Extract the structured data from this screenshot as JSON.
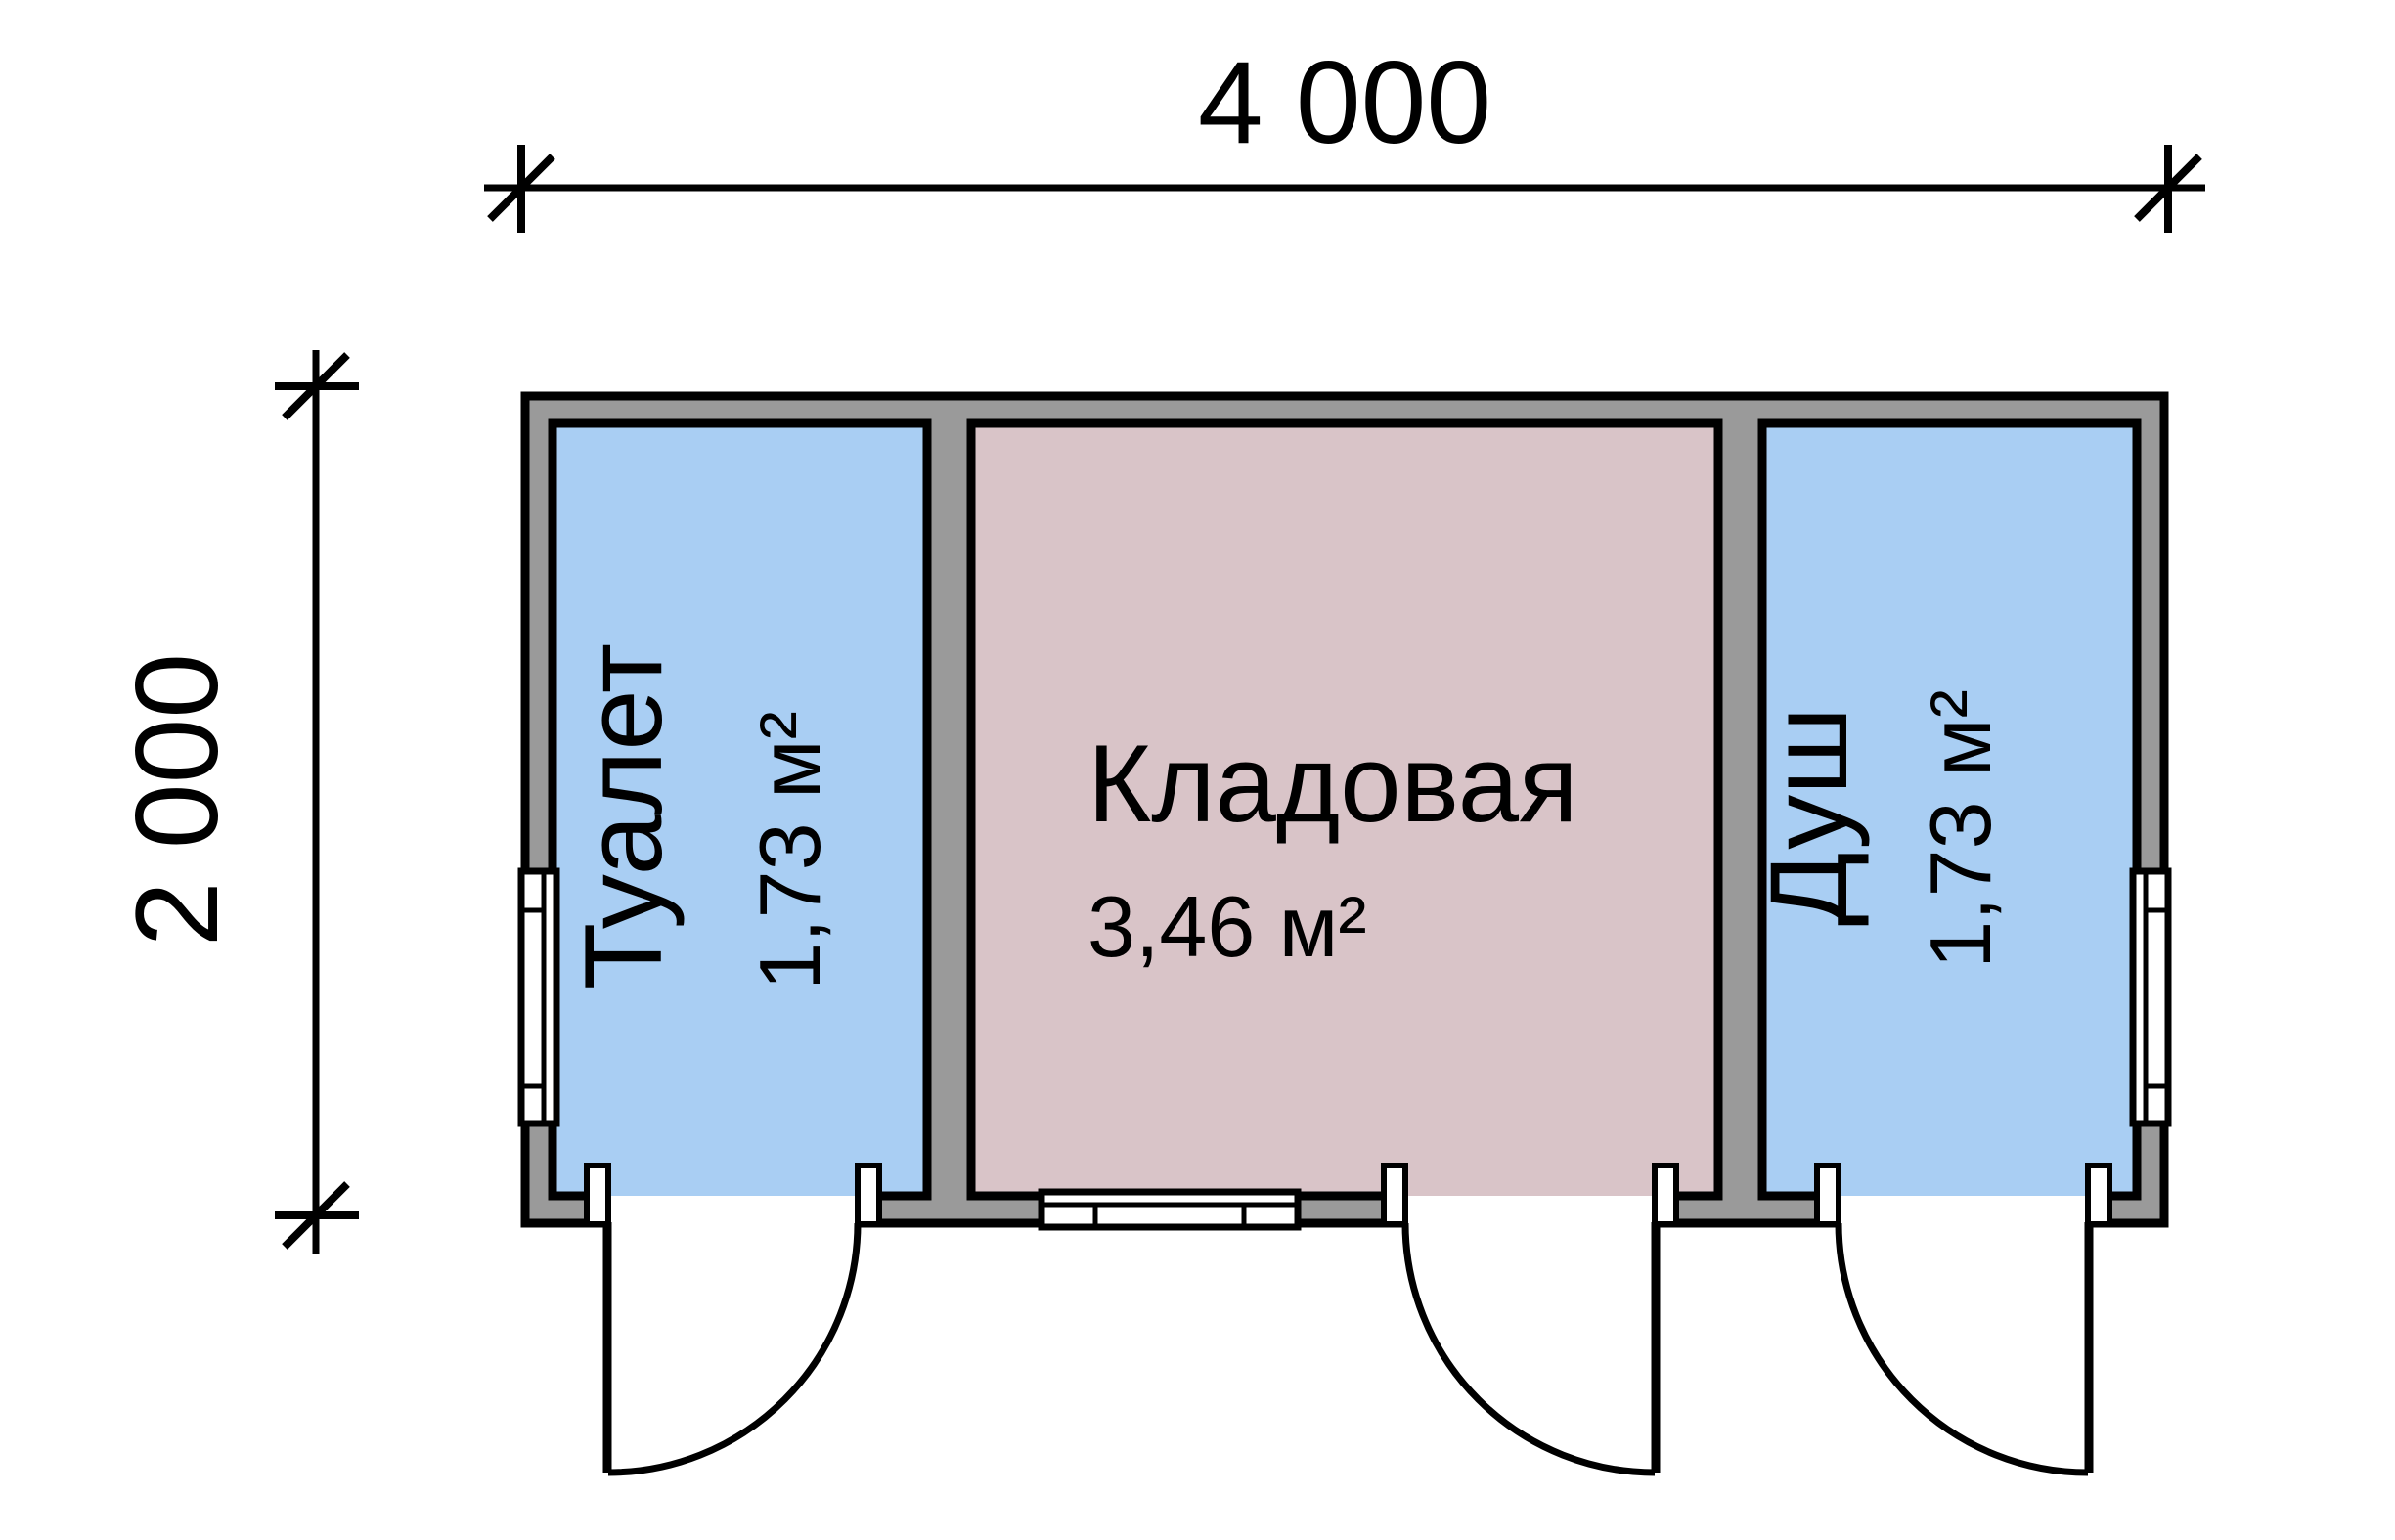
{
  "title": "Cabin floor plan 4000x2000 with three rooms",
  "dimensions": {
    "width": "4 000",
    "height": "2 000"
  },
  "rooms": [
    {
      "name": "Туалет",
      "area": "1,73 м²",
      "fill": "#a9cef3"
    },
    {
      "name": "Кладовая",
      "area": "3,46 м²",
      "fill": "#d9c4c8"
    },
    {
      "name": "Душ",
      "area": "1,73 м²",
      "fill": "#a9cef3"
    }
  ],
  "colors": {
    "wall": "#9a9a9a",
    "line": "#000000",
    "window": "#ffffff",
    "background": "#ffffff"
  }
}
